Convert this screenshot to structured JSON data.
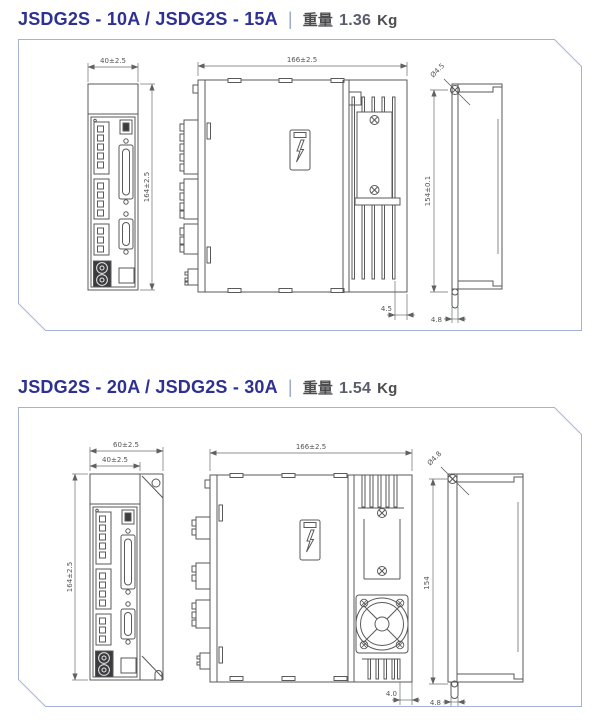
{
  "sections": [
    {
      "title": {
        "model": "JSDG2S - 10A / JSDG2S - 15A",
        "separator": "|",
        "weight_label": "重量",
        "weight_value": "1.36",
        "weight_unit": "Kg"
      },
      "dims": {
        "front_width": "40±2.5",
        "front_height": "164±2.5",
        "side_width": "166±2.5",
        "side_gap": "4.5",
        "hole_diameter": "Ø4.5",
        "mount_height": "154±0.1",
        "mount_offset": "4.8"
      }
    },
    {
      "title": {
        "model": "JSDG2S - 20A / JSDG2S - 30A",
        "separator": "|",
        "weight_label": "重量",
        "weight_value": "1.54",
        "weight_unit": "Kg"
      },
      "dims": {
        "front_width_outer": "60±2.5",
        "front_width": "40±2.5",
        "front_height": "164±2.5",
        "side_width": "166±2.5",
        "side_gap": "4.0",
        "hole_diameter": "Ø4.8",
        "mount_height": "154",
        "mount_offset": "4.8"
      }
    }
  ],
  "colors": {
    "title_blue": "#2e3192",
    "panel_border": "#a3b2d6",
    "drawing_line": "#58595b"
  }
}
